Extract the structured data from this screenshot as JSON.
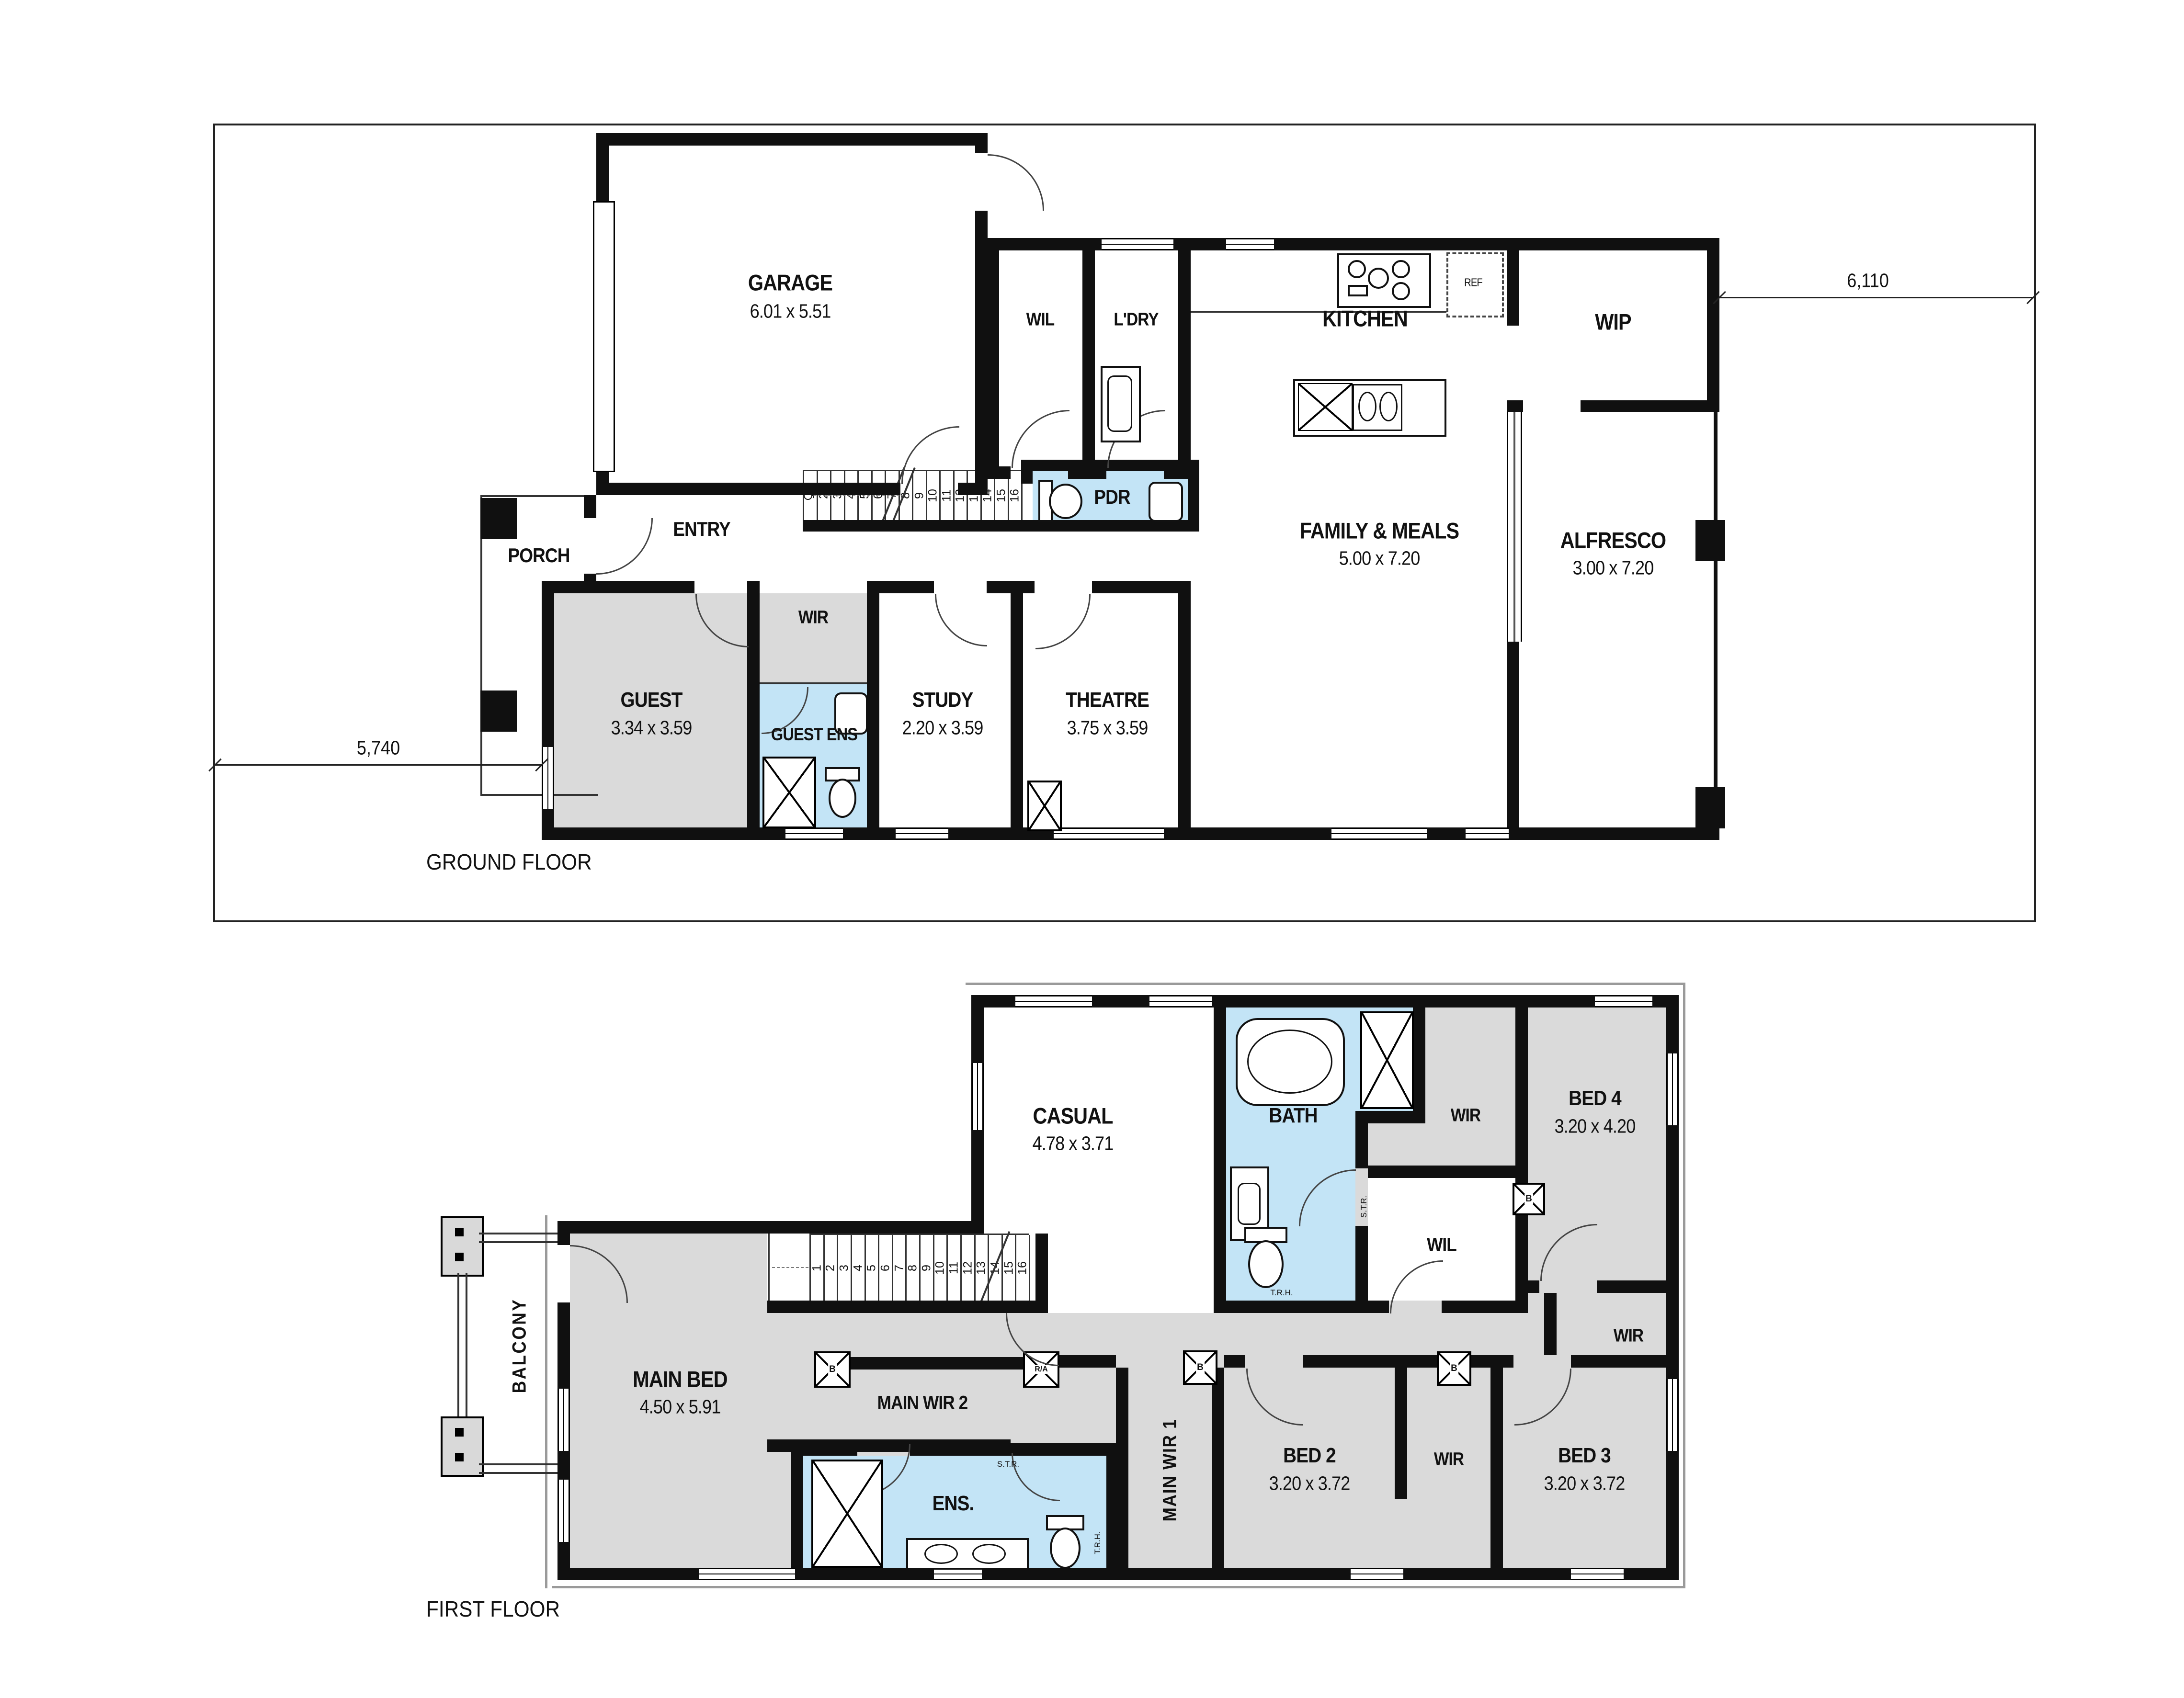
{
  "colors": {
    "wall": "#101010",
    "wet_area": "#c3e4f6",
    "room_gray": "#dadada",
    "outline": "#222222"
  },
  "ground": {
    "title": "GROUND FLOOR",
    "dim_side": "6,110",
    "dim_front": "5,740",
    "stairs": [
      "1",
      "2",
      "3",
      "4",
      "5",
      "6",
      "7",
      "8",
      "9",
      "10",
      "11",
      "12",
      "13",
      "14",
      "15",
      "16"
    ],
    "rooms": {
      "garage": {
        "name": "GARAGE",
        "size": "6.01 x 5.51"
      },
      "wil": {
        "name": "WIL"
      },
      "ldry": {
        "name": "L'DRY"
      },
      "kitchen": {
        "name": "KITCHEN"
      },
      "wip": {
        "name": "WIP"
      },
      "fridge": {
        "name": "REF"
      },
      "porch": {
        "name": "PORCH"
      },
      "entry": {
        "name": "ENTRY"
      },
      "pdr": {
        "name": "PDR"
      },
      "family": {
        "name": "FAMILY & MEALS",
        "size": "5.00 x 7.20"
      },
      "alfresco": {
        "name": "ALFRESCO",
        "size": "3.00 x 7.20"
      },
      "guest": {
        "name": "GUEST",
        "size": "3.34 x 3.59"
      },
      "wir": {
        "name": "WIR"
      },
      "guest_ens": {
        "name": "GUEST ENS"
      },
      "study": {
        "name": "STUDY",
        "size": "2.20 x 3.59"
      },
      "theatre": {
        "name": "THEATRE",
        "size": "3.75 x 3.59"
      }
    }
  },
  "first": {
    "title": "FIRST FLOOR",
    "stairs": [
      "1",
      "2",
      "3",
      "4",
      "5",
      "6",
      "7",
      "8",
      "9",
      "10",
      "11",
      "12",
      "13",
      "14",
      "15",
      "16"
    ],
    "rooms": {
      "casual": {
        "name": "CASUAL",
        "size": "4.78 x 3.71"
      },
      "bath": {
        "name": "BATH"
      },
      "wir_top": {
        "name": "WIR"
      },
      "bed4": {
        "name": "BED 4",
        "size": "3.20 x 4.20"
      },
      "wil": {
        "name": "WIL"
      },
      "balcony": {
        "name": "BALCONY"
      },
      "main_bed": {
        "name": "MAIN BED",
        "size": "4.50 x 5.91"
      },
      "main_wir2": {
        "name": "MAIN WIR 2"
      },
      "main_wir1": {
        "name": "MAIN WIR 1"
      },
      "ens": {
        "name": "ENS."
      },
      "bed2": {
        "name": "BED 2",
        "size": "3.20 x 3.72"
      },
      "wir_mid": {
        "name": "WIR"
      },
      "bed3": {
        "name": "BED 3",
        "size": "3.20 x 3.72"
      },
      "wir_right": {
        "name": "WIR"
      }
    },
    "tiny": {
      "str": "S.T.R.",
      "trh": "T.R.H.",
      "b": "B",
      "ra": "R/A"
    }
  }
}
